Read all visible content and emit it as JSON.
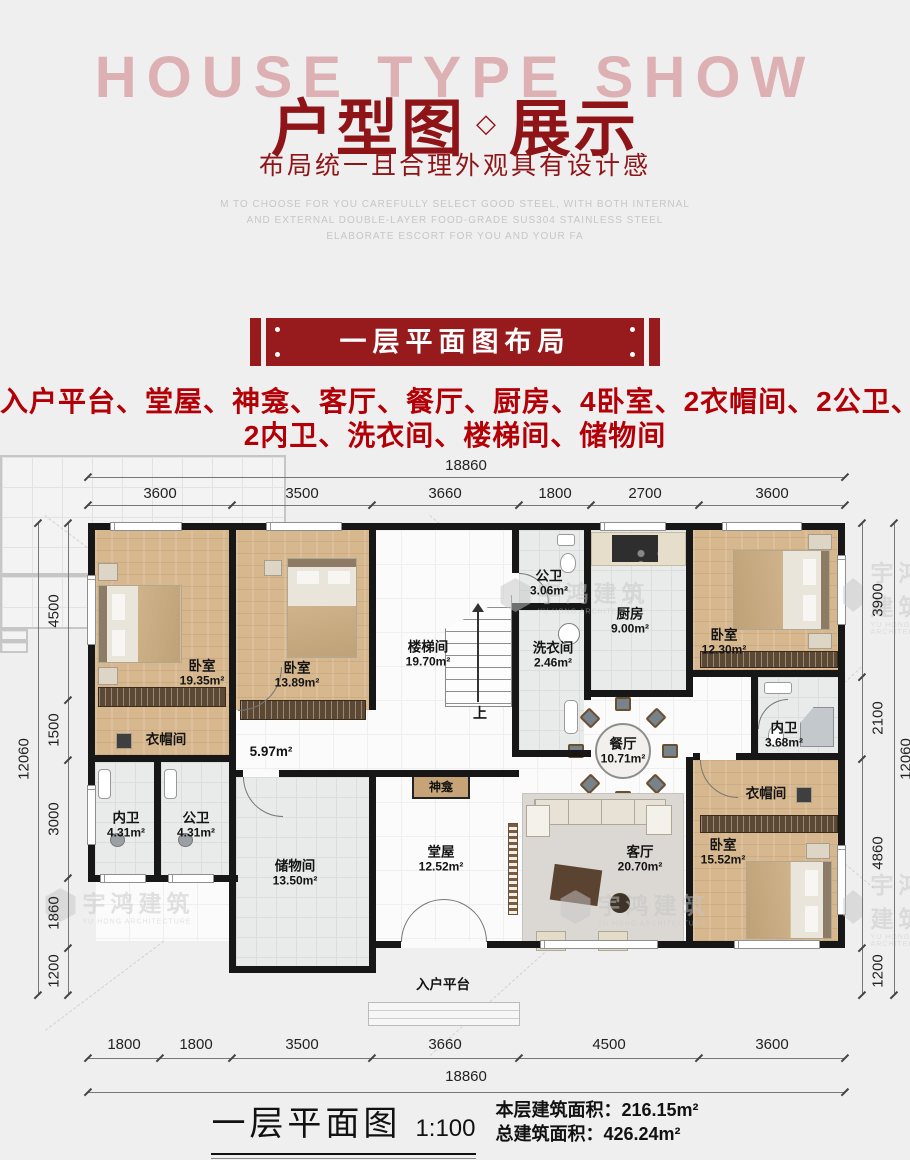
{
  "header": {
    "watermark": "HOUSE TYPE SHOW",
    "title_left": "户型图",
    "title_diamond": "◇",
    "title_right": "展示",
    "subtitle": "布局统一且合理外观具有设计感",
    "english_lines": [
      "M TO CHOOSE FOR YOU CAREFULLY SELECT GOOD STEEL, WITH BOTH INTERNAL",
      "AND EXTERNAL DOUBLE-LAYER FOOD-GRADE SUS304 STAINLESS STEEL",
      "ELABORATE ESCORT FOR YOU AND YOUR FA"
    ]
  },
  "banner": {
    "label": "一层平面图布局"
  },
  "features": {
    "line1": "入户平台、堂屋、神龛、客厅、餐厅、厨房、4卧室、2衣帽间、2公卫、",
    "line2": "2内卫、洗衣间、楼梯间、储物间"
  },
  "dimensions": {
    "top_total": "18860",
    "top_segments": [
      "3600",
      "3500",
      "3660",
      "1800",
      "2700",
      "3600"
    ],
    "bottom_segments": [
      "1800",
      "1800",
      "3500",
      "3660",
      "4500",
      "3600"
    ],
    "bottom_total": "18860",
    "left_outer": "12060",
    "left_segments": [
      "4500",
      "1500",
      "3000",
      "1860",
      "1200"
    ],
    "right_segments": [
      "3900",
      "2100",
      "4860",
      "1200"
    ],
    "right_outer": "12060"
  },
  "rooms": {
    "bedroom_tl": {
      "name": "卧室",
      "area": "19.35m²"
    },
    "bedroom_tm": {
      "name": "卧室",
      "area": "13.89m²"
    },
    "stairwell": {
      "name": "楼梯间",
      "area": "19.70m²"
    },
    "public_bath_top": {
      "name": "公卫",
      "area": "3.06m²"
    },
    "laundry": {
      "name": "洗衣间",
      "area": "2.46m²"
    },
    "kitchen": {
      "name": "厨房",
      "area": "9.00m²"
    },
    "bedroom_tr": {
      "name": "卧室",
      "area": "12.30m²"
    },
    "cloak_left": {
      "name": "衣帽间"
    },
    "hallway": {
      "area": "5.97m²"
    },
    "master_bath_right": {
      "name": "内卫",
      "area": "3.68m²"
    },
    "dining": {
      "name": "餐厅",
      "area": "10.71m²"
    },
    "shrine": {
      "name": "神龛"
    },
    "cloak_right": {
      "name": "衣帽间"
    },
    "master_bath_bl": {
      "name": "内卫",
      "area": "4.31m²"
    },
    "public_bath_bl": {
      "name": "公卫",
      "area": "4.31m²"
    },
    "storage": {
      "name": "储物间",
      "area": "13.50m²"
    },
    "hall": {
      "name": "堂屋",
      "area": "12.52m²"
    },
    "living": {
      "name": "客厅",
      "area": "20.70m²"
    },
    "bedroom_br": {
      "name": "卧室",
      "area": "15.52m²"
    },
    "platform": {
      "name": "入户平台"
    },
    "stairs_up": "上"
  },
  "plan_watermark": {
    "cn": "宇鸿建筑",
    "en": "YU HONG ARCHITECTURE"
  },
  "footer": {
    "plan_title": "一层平面图",
    "scale": "1:100",
    "floor_area_label": "本层建筑面积：",
    "floor_area_value": "216.15m²",
    "total_area_label": "总建筑面积：",
    "total_area_value": "426.24m²"
  },
  "colors": {
    "brand_red": "#971a1d",
    "feature_red": "#b30006"
  }
}
